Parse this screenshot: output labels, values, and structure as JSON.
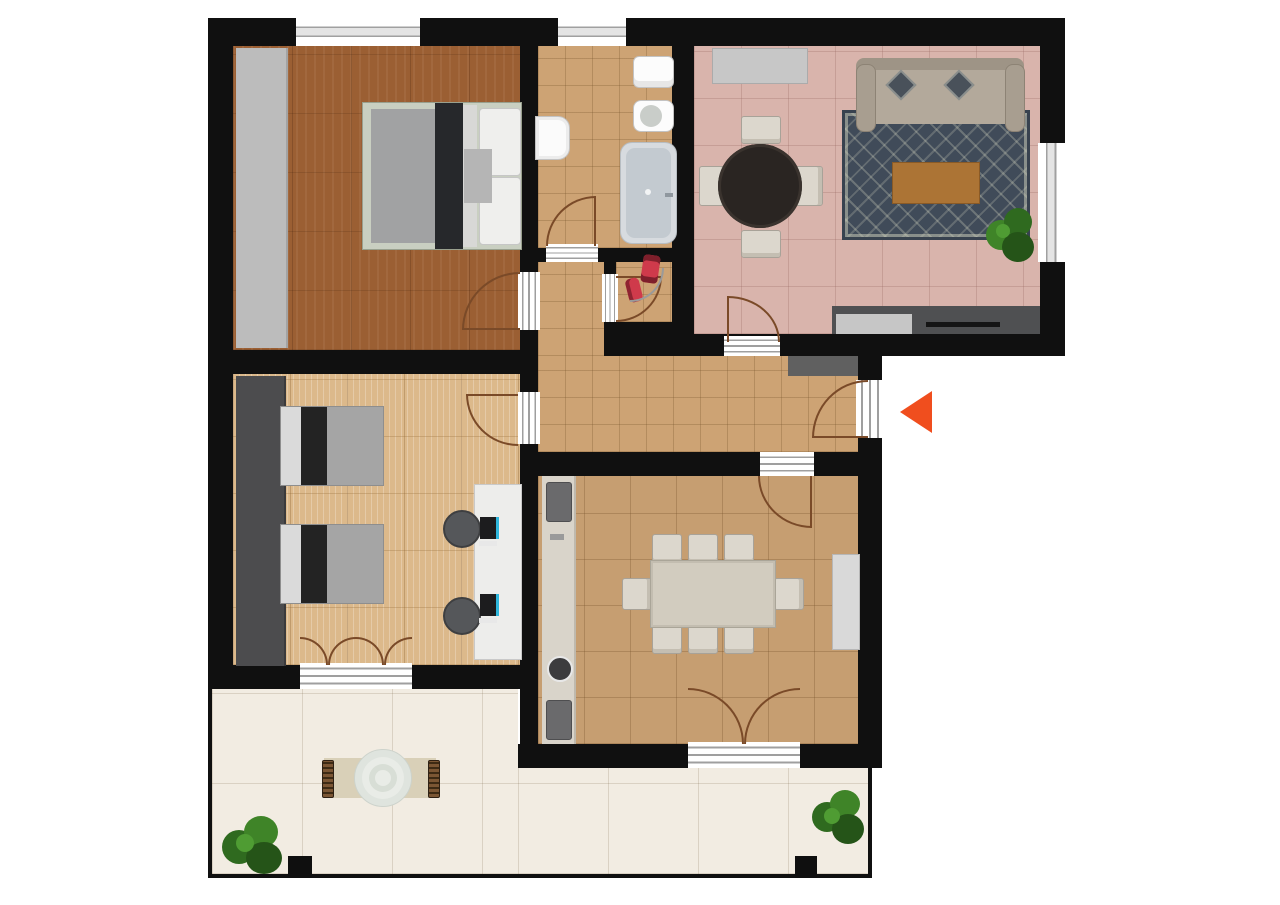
{
  "plan": {
    "type": "apartment-floor-plan",
    "view": "top-down",
    "background_color": "#ffffff",
    "wall_color": "#101010",
    "door_swing_color": "#7a4a28"
  },
  "entrance": {
    "marker": "triangle-arrow",
    "color": "#F04E1E",
    "direction": "left",
    "location": "right-wall-of-hallway"
  },
  "rooms": [
    {
      "name": "master-bedroom",
      "floor": "dark-wood-parquet",
      "floor_color": "#9b5f33",
      "furniture": [
        "wardrobe",
        "double-bed-with-pillows"
      ],
      "windows": 1,
      "doors": 1
    },
    {
      "name": "bathroom",
      "floor": "small-beige-tile",
      "floor_color": "#cda374",
      "furniture": [
        "washbasin",
        "toilet",
        "bidet",
        "bathtub"
      ],
      "windows": 1,
      "doors": 1
    },
    {
      "name": "living-room",
      "floor": "rose-tile",
      "floor_color": "#d9b4ac",
      "furniture": [
        "sideboard",
        "round-dining-table",
        "4-chairs",
        "sofa",
        "patterned-rug",
        "coffee-table",
        "plant",
        "kitchen-counter-with-sink-and-cooktop"
      ],
      "windows": 1,
      "doors": 1
    },
    {
      "name": "storage-nook",
      "floor": "small-beige-tile",
      "floor_color": "#cda374",
      "furniture": [
        "red-equipment",
        "red-equipment"
      ],
      "doors": 1
    },
    {
      "name": "hallway",
      "floor": "small-beige-tile",
      "floor_color": "#cda374",
      "furniture": [
        "doormat"
      ],
      "doors": 1
    },
    {
      "name": "twin-bedroom",
      "floor": "light-wood",
      "floor_color": "#dcb98b",
      "furniture": [
        "wardrobe",
        "single-bed",
        "single-bed",
        "double-desk",
        "office-chair",
        "office-chair",
        "monitor",
        "monitor"
      ],
      "doors": 1,
      "french_doors": 1
    },
    {
      "name": "dining-room",
      "floor": "medium-beige-tile",
      "floor_color": "#c69e71",
      "furniture": [
        "kitchenette-strip",
        "appliance",
        "appliance",
        "round-sink",
        "dining-table",
        "8-chairs",
        "sideboard"
      ],
      "doors": 1,
      "french_doors": 1
    },
    {
      "name": "terrace",
      "floor": "cream-stone-tile",
      "floor_color": "#f2ece2",
      "furniture": [
        "outdoor-mat",
        "round-table",
        "bench",
        "bench",
        "bush",
        "bush",
        "pillar",
        "pillar"
      ]
    }
  ]
}
